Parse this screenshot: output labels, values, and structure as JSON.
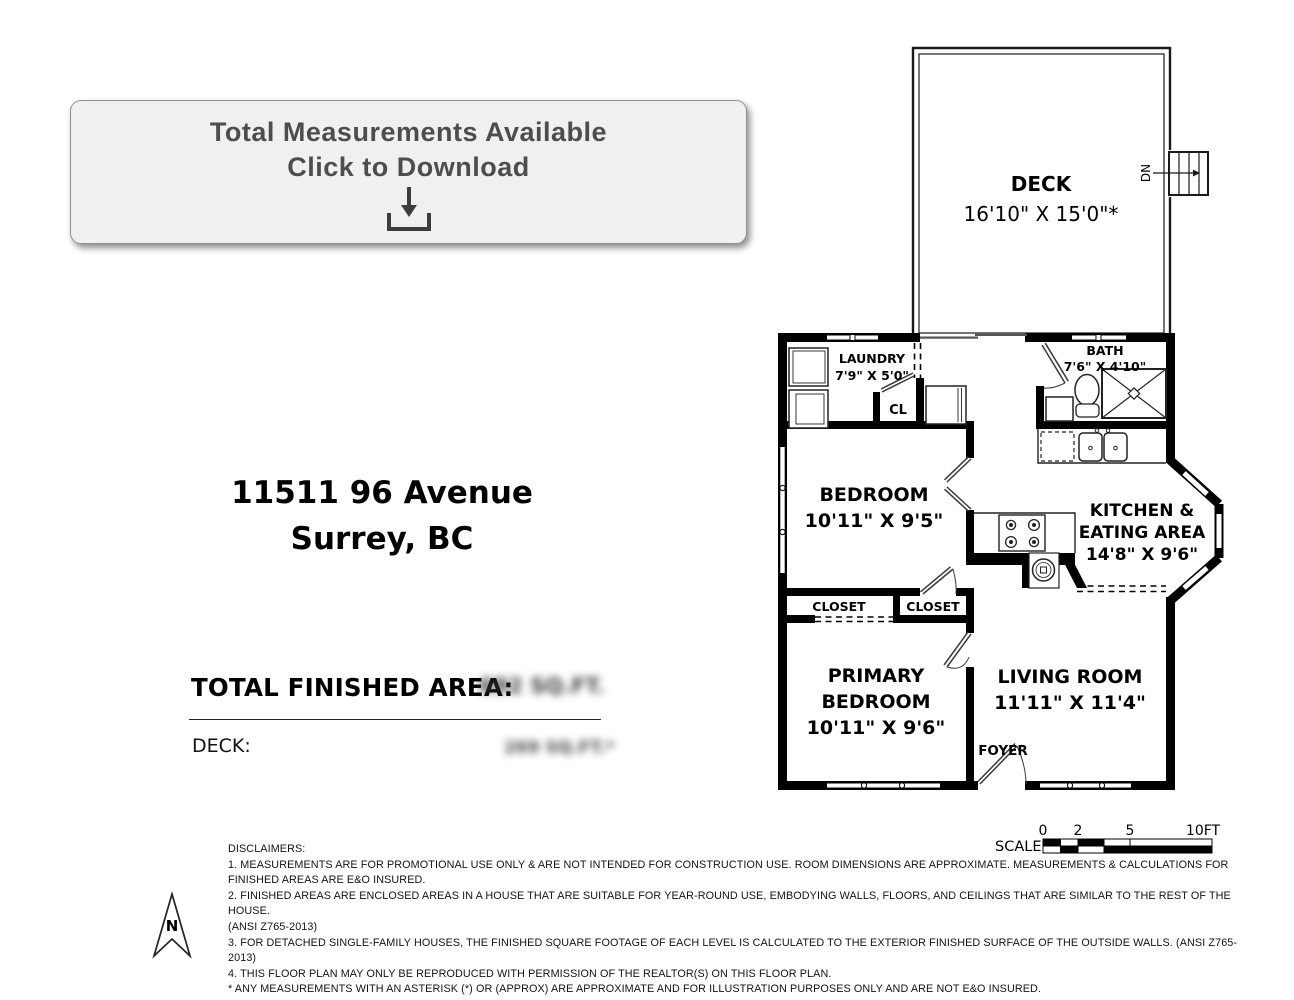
{
  "download_button": {
    "line1": "Total Measurements Available",
    "line2": "Click to Download"
  },
  "address": {
    "line1": "11511 96 Avenue",
    "line2": "Surrey, BC"
  },
  "areas": {
    "total_label": "TOTAL FINISHED AREA:",
    "total_value_blurred": "692 SQ.FT.",
    "deck_label": "DECK:",
    "deck_value_blurred": "269 SQ.FT.*"
  },
  "plan": {
    "deck": {
      "name": "DECK",
      "dims": "16'10\" X 15'0\"*"
    },
    "stairs_dn": "DN",
    "laundry": {
      "name": "LAUNDRY",
      "dims": "7'9\" X 5'0\""
    },
    "closet_cl": "CL",
    "bath": {
      "name": "BATH",
      "dims": "7'6\" X 4'10\""
    },
    "bedroom": {
      "name": "BEDROOM",
      "dims": "10'11\" X 9'5\""
    },
    "kitchen": {
      "name_line1": "KITCHEN &",
      "name_line2": "EATING AREA",
      "dims": "14'8\" X 9'6\""
    },
    "closet_left": "CLOSET",
    "closet_right": "CLOSET",
    "primary_bedroom": {
      "name_line1": "PRIMARY",
      "name_line2": "BEDROOM",
      "dims": "10'11\" X 9'6\""
    },
    "living_room": {
      "name": "LIVING ROOM",
      "dims": "11'11\" X 11'4\""
    },
    "foyer": "FOYER"
  },
  "scale_bar": {
    "label": "SCALE",
    "tick0": "0",
    "tick2": "2",
    "tick5": "5",
    "tick10": "10FT"
  },
  "compass": {
    "label": "N"
  },
  "disclaimers": "DISCLAIMERS:\n1. MEASUREMENTS ARE FOR PROMOTIONAL USE ONLY & ARE NOT INTENDED FOR CONSTRUCTION USE. ROOM DIMENSIONS ARE APPROXIMATE. MEASUREMENTS & CALCULATIONS FOR\nFINISHED AREAS ARE E&O INSURED.\n2. FINISHED AREAS ARE ENCLOSED AREAS IN A HOUSE THAT ARE SUITABLE FOR YEAR-ROUND USE, EMBODYING WALLS, FLOORS, AND CEILINGS THAT ARE SIMILAR TO THE REST OF THE HOUSE.\n(ANSI Z765-2013)\n3. FOR DETACHED SINGLE-FAMILY HOUSES, THE FINISHED SQUARE FOOTAGE OF EACH LEVEL IS CALCULATED TO THE EXTERIOR FINISHED SURFACE OF THE OUTSIDE WALLS. (ANSI Z765-2013)\n4. THIS FLOOR PLAN MAY ONLY BE REPRODUCED WITH PERMISSION OF THE REALTOR(S) ON THIS FLOOR PLAN.\n* ANY MEASUREMENTS WITH AN ASTERISK (*) OR (APPROX) ARE APPROXIMATE AND FOR ILLUSTRATION PURPOSES ONLY AND ARE NOT E&O INSURED."
}
